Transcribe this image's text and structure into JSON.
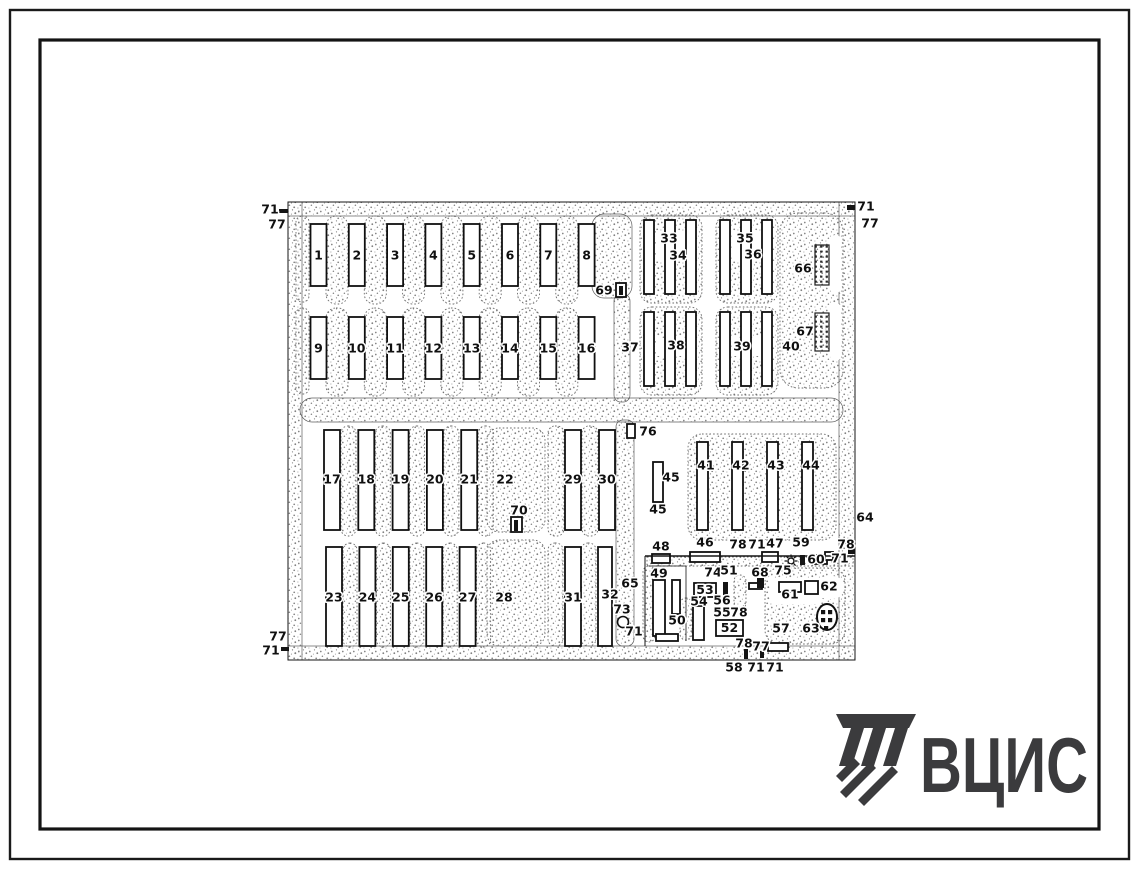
{
  "logo": {
    "text": "ВЦИС",
    "color": "#3b3b3d"
  },
  "plan": {
    "roads": [
      [
        288,
        202,
        567,
        14,
        0
      ],
      [
        288,
        202,
        14,
        458,
        0
      ],
      [
        288,
        646,
        567,
        14,
        0
      ],
      [
        839,
        202,
        16,
        458,
        0
      ],
      [
        300,
        398,
        543,
        24,
        12
      ],
      [
        592,
        214,
        40,
        84,
        12
      ],
      [
        614,
        294,
        16,
        108,
        7
      ],
      [
        616,
        420,
        18,
        226,
        7
      ]
    ],
    "paddock_groups": [
      {
        "x0": 326,
        "y": 216,
        "w": 22,
        "h": 88,
        "p": 38.3,
        "n": 7,
        "rx": 10
      },
      {
        "x0": 326,
        "y": 308,
        "w": 22,
        "h": 88,
        "p": 38.3,
        "n": 7,
        "rx": 10
      },
      {
        "x0": 341,
        "y": 426,
        "w": 15,
        "h": 110,
        "p": 34.3,
        "n": 5,
        "rx": 7
      },
      {
        "x0": 548,
        "y": 426,
        "w": 16,
        "h": 110,
        "p": 34,
        "n": 2,
        "rx": 7
      },
      {
        "x0": 343,
        "y": 543,
        "w": 14,
        "h": 104,
        "p": 33.4,
        "n": 5,
        "rx": 7
      },
      {
        "x0": 548,
        "y": 543,
        "w": 15,
        "h": 103,
        "p": 33,
        "n": 2,
        "rx": 7
      }
    ],
    "blocks": [
      [
        296,
        216,
        13,
        86,
        6
      ],
      [
        296,
        308,
        13,
        86,
        6
      ],
      [
        640,
        215,
        62,
        88,
        12
      ],
      [
        716,
        215,
        62,
        88,
        12
      ],
      [
        640,
        307,
        62,
        88,
        12
      ],
      [
        716,
        307,
        62,
        88,
        12
      ],
      [
        780,
        213,
        63,
        175,
        18
      ],
      [
        487,
        428,
        58,
        104,
        12
      ],
      [
        487,
        540,
        58,
        106,
        12
      ],
      [
        688,
        434,
        148,
        106,
        14
      ],
      [
        647,
        557,
        206,
        9,
        0
      ],
      [
        643,
        566,
        12,
        76,
        6
      ],
      [
        680,
        598,
        12,
        42,
        6
      ],
      [
        765,
        568,
        80,
        76,
        14
      ],
      [
        734,
        575,
        12,
        34,
        6
      ]
    ],
    "notches": [
      [
        656,
        231,
        34,
        30,
        0
      ],
      [
        732,
        231,
        34,
        30,
        0
      ],
      [
        656,
        338,
        36,
        18,
        0
      ],
      [
        732,
        338,
        36,
        18,
        0
      ],
      [
        830,
        235,
        11,
        58,
        5
      ],
      [
        830,
        303,
        11,
        58,
        5
      ],
      [
        770,
        578,
        50,
        26,
        4
      ],
      [
        816,
        576,
        28,
        23,
        11
      ]
    ],
    "building_groups": [
      {
        "x0": 310.5,
        "y": 224,
        "w": 16,
        "h": 62,
        "p": 38.3,
        "n": 8,
        "s": 1,
        "ny": 256,
        "dx": 0
      },
      {
        "x0": 310.5,
        "y": 317,
        "w": 16,
        "h": 62,
        "p": 38.3,
        "n": 8,
        "s": 9,
        "ny": 349,
        "dx": 0
      },
      {
        "x0": 324,
        "y": 430,
        "w": 16,
        "h": 100,
        "p": 34.3,
        "n": 5,
        "s": 17,
        "ny": 480,
        "dx": 0
      },
      {
        "x0": 565,
        "y": 430,
        "w": 16,
        "h": 100,
        "p": 34,
        "n": 2,
        "s": 29,
        "ny": 480,
        "dx": 0
      },
      {
        "x0": 326,
        "y": 547,
        "w": 16,
        "h": 99,
        "p": 33.4,
        "n": 5,
        "s": 23,
        "ny": 598,
        "dx": 0
      },
      {
        "x0": 565,
        "y": 547,
        "w": 16,
        "h": 99,
        "p": 33,
        "n": 1,
        "s": 31,
        "ny": 598,
        "dx": 0
      },
      {
        "x0": 697,
        "y": 442,
        "w": 11,
        "h": 88,
        "p": 35,
        "n": 4,
        "s": 41,
        "ny": 466,
        "dx": 3.5
      }
    ],
    "white_rects": [
      [
        644,
        220,
        10,
        74
      ],
      [
        665,
        220,
        10,
        74
      ],
      [
        686,
        220,
        10,
        74
      ],
      [
        720,
        220,
        10,
        74
      ],
      [
        741,
        220,
        10,
        74
      ],
      [
        762,
        220,
        10,
        74
      ],
      [
        644,
        312,
        10,
        74
      ],
      [
        665,
        312,
        10,
        74
      ],
      [
        686,
        312,
        10,
        74
      ],
      [
        720,
        312,
        10,
        74
      ],
      [
        741,
        312,
        10,
        74
      ],
      [
        762,
        312,
        10,
        74
      ],
      [
        598,
        547,
        14,
        99
      ],
      [
        653,
        462,
        10,
        40
      ],
      [
        627,
        424,
        8,
        14
      ],
      [
        616,
        283,
        10,
        14
      ],
      [
        511,
        517,
        11,
        15
      ],
      [
        652,
        554,
        18,
        9
      ],
      [
        690,
        552,
        30,
        10
      ],
      [
        762,
        552,
        16,
        10
      ],
      [
        815,
        555,
        12,
        9
      ],
      [
        825,
        552,
        8,
        8
      ],
      [
        653,
        580,
        12,
        56
      ],
      [
        672,
        580,
        8,
        34
      ],
      [
        656,
        634,
        22,
        7
      ],
      [
        693,
        606,
        11,
        34
      ],
      [
        749,
        583,
        13,
        6
      ],
      [
        779,
        582,
        22,
        10
      ],
      [
        805,
        581,
        13,
        13
      ],
      [
        768,
        643,
        20,
        8
      ]
    ],
    "boxed": [
      [
        "53",
        694,
        583,
        22,
        14
      ],
      [
        "52",
        716,
        620,
        27,
        16
      ]
    ],
    "dark_rects": [
      [
        619,
        286,
        4,
        9
      ],
      [
        514,
        520,
        4,
        11
      ],
      [
        723,
        582,
        5,
        13
      ],
      [
        757,
        578,
        7,
        10
      ],
      [
        800,
        555,
        5,
        10
      ],
      [
        744,
        649,
        4,
        10
      ],
      [
        760,
        651,
        4,
        7
      ],
      [
        279,
        209,
        9,
        4
      ],
      [
        847,
        205,
        8,
        5
      ],
      [
        281,
        647,
        8,
        4
      ],
      [
        848,
        549,
        7,
        5
      ]
    ],
    "hatch_rects": [
      [
        815,
        245,
        14,
        40
      ],
      [
        815,
        313,
        14,
        38
      ]
    ],
    "circles": [
      [
        623,
        622,
        5.5
      ]
    ],
    "sun": [
      791,
      561
    ],
    "tank": {
      "cx": 827,
      "cy": 617,
      "rx": 10,
      "ry": 13
    },
    "lines": [
      [
        "M288,202 H855 V660 H288 Z",
        1
      ],
      [
        "M645,556 H855",
        1.4
      ],
      [
        "M645,556 V646",
        1
      ],
      [
        "M686,566 V641",
        0.8
      ],
      [
        "M649,566 H686",
        0.8
      ]
    ],
    "labels": [
      [
        "71",
        270,
        210
      ],
      [
        "77",
        277,
        225
      ],
      [
        "71",
        866,
        207
      ],
      [
        "77",
        870,
        224
      ],
      [
        "77",
        278,
        637
      ],
      [
        "71",
        271,
        651
      ],
      [
        "64",
        865,
        518
      ],
      [
        "58",
        734,
        668
      ],
      [
        "71",
        756,
        668
      ],
      [
        "71",
        775,
        668
      ],
      [
        "69",
        604,
        291
      ],
      [
        "33",
        669,
        239
      ],
      [
        "34",
        678,
        256
      ],
      [
        "35",
        745,
        239
      ],
      [
        "36",
        753,
        255
      ],
      [
        "37",
        630,
        348
      ],
      [
        "38",
        676,
        346
      ],
      [
        "39",
        742,
        347
      ],
      [
        "66",
        803,
        269
      ],
      [
        "67",
        805,
        332
      ],
      [
        "40",
        791,
        347
      ],
      [
        "76",
        648,
        432
      ],
      [
        "22",
        505,
        480
      ],
      [
        "28",
        504,
        598
      ],
      [
        "32",
        610,
        595
      ],
      [
        "45",
        671,
        478
      ],
      [
        "45",
        658,
        510
      ],
      [
        "70",
        519,
        511
      ],
      [
        "65",
        630,
        584
      ],
      [
        "73",
        622,
        610
      ],
      [
        "71",
        634,
        632
      ],
      [
        "48",
        661,
        547
      ],
      [
        "46",
        705,
        543
      ],
      [
        "78",
        738,
        545
      ],
      [
        "71",
        757,
        545
      ],
      [
        "47",
        775,
        544
      ],
      [
        "59",
        801,
        543
      ],
      [
        "78",
        846,
        545
      ],
      [
        "60",
        816,
        560
      ],
      [
        "71",
        840,
        559
      ],
      [
        "49",
        659,
        574
      ],
      [
        "74",
        713,
        573
      ],
      [
        "51",
        729,
        571
      ],
      [
        "68",
        760,
        573
      ],
      [
        "75",
        783,
        571
      ],
      [
        "62",
        829,
        587
      ],
      [
        "61",
        790,
        595
      ],
      [
        "54",
        699,
        602
      ],
      [
        "56",
        722,
        601
      ],
      [
        "55",
        722,
        613
      ],
      [
        "78",
        739,
        613
      ],
      [
        "50",
        677,
        621
      ],
      [
        "57",
        781,
        629
      ],
      [
        "63",
        811,
        629
      ],
      [
        "78",
        744,
        644
      ],
      [
        "77",
        761,
        647
      ]
    ]
  }
}
